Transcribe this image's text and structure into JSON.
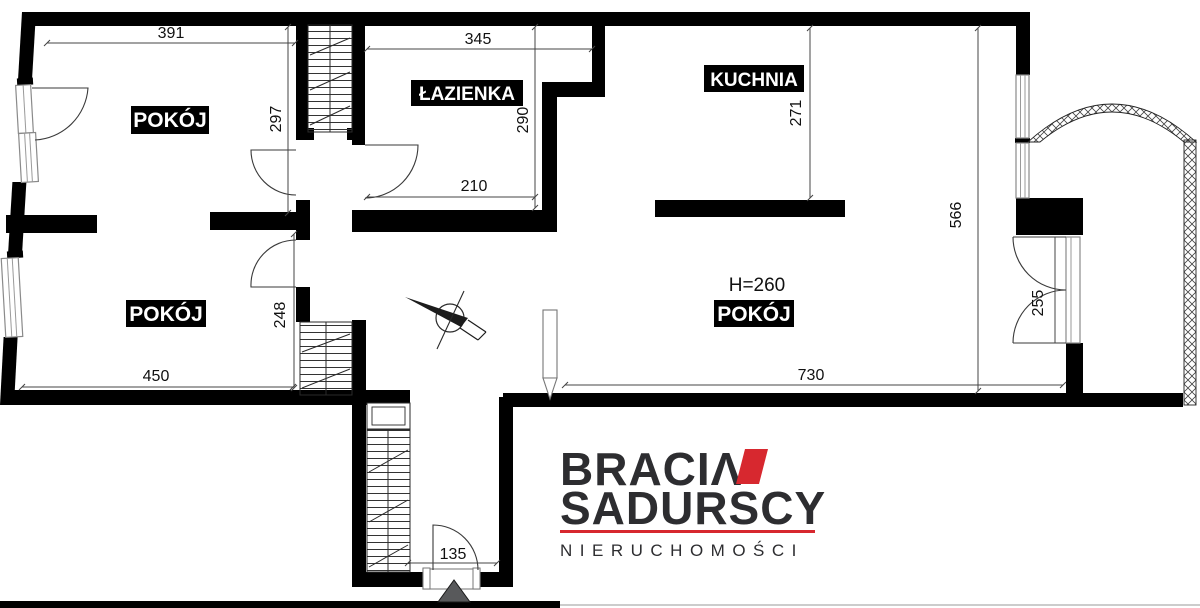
{
  "plan": {
    "rooms": {
      "room1": "POKÓJ",
      "bathroom": "ŁAZIENKA",
      "kitchen": "KUCHNIA",
      "room2": "POKÓJ",
      "room3": "POKÓJ"
    },
    "dims": {
      "room1_width": "391",
      "room1_height": "297",
      "bathroom_width": "345",
      "bathroom_height": "290",
      "bathroom_bottom": "210",
      "kitchen_height": "271",
      "right_side_height": "566",
      "balcony_door": "255",
      "room2_height": "248",
      "room2_width": "450",
      "room3_width": "730",
      "entrance_width": "135",
      "ceiling_height": "H=260"
    }
  },
  "logo": {
    "brand_line1": "BRACIΛ",
    "brand_line2": "SADURSCY",
    "tagline": "NIERUCHOMOŚCI"
  },
  "colors": {
    "walls": "#000000",
    "accent_red": "#d7282f",
    "label_bg": "#000000",
    "label_text": "#ffffff"
  }
}
